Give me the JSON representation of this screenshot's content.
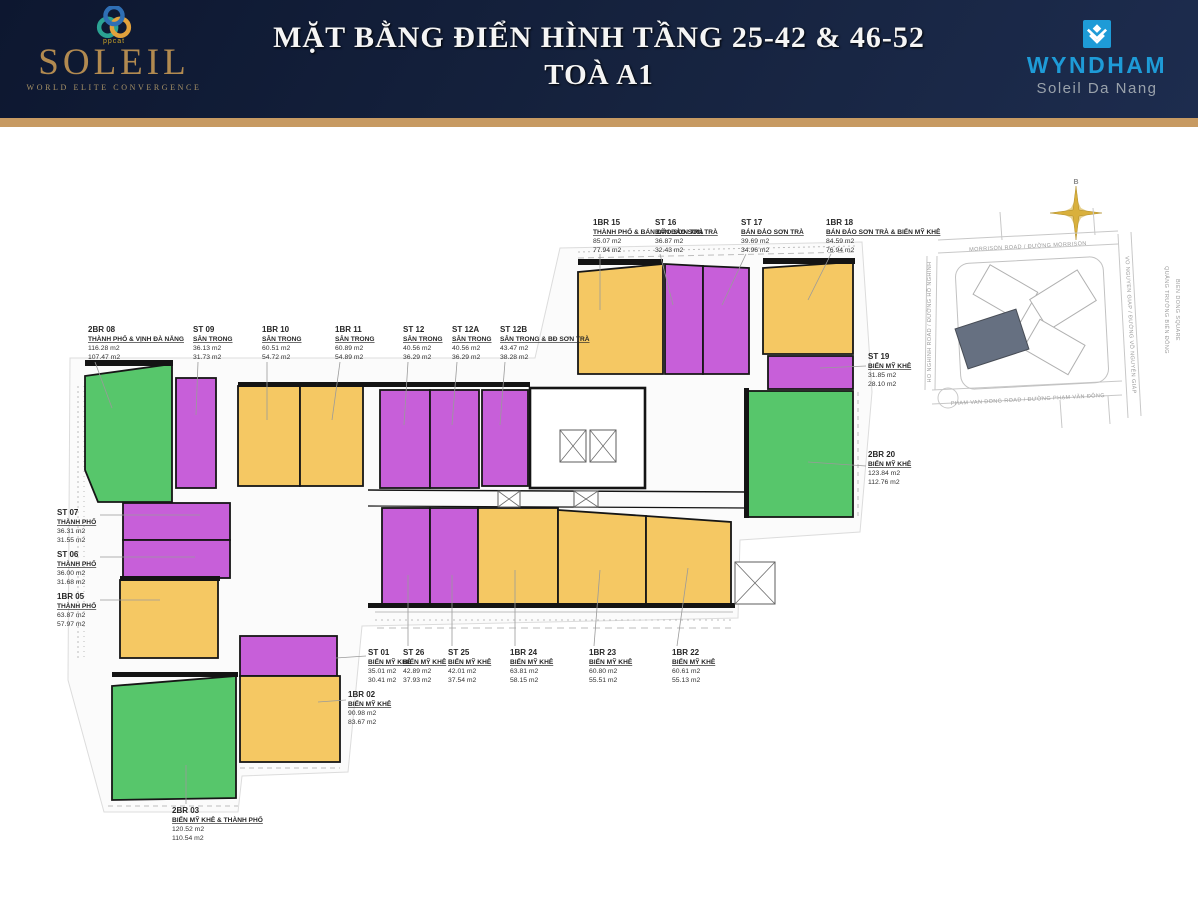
{
  "header": {
    "logo": {
      "name": "SOLEIL",
      "tagline": "WORLD ELITE CONVERGENCE",
      "mark_text": "ppcat"
    },
    "title_line1": "MẶT BẰNG ĐIỂN HÌNH TẦNG 25-42 & 46-52",
    "title_line2": "TOÀ A1",
    "partner": {
      "name": "WYNDHAM",
      "subtitle": "Soleil Da Nang"
    }
  },
  "colors": {
    "studio": "#c75fd9",
    "one_bedroom": "#f5c863",
    "two_bedroom": "#57c66b",
    "header_navy": "#16233f",
    "gold_bar": "#c79a62",
    "wyndham_blue": "#1e9bd7",
    "soleil_gold": "#b28a50"
  },
  "plan": {
    "units": [
      {
        "id": "2br08",
        "code": "2BR 08",
        "view": "THÀNH PHỐ & VỊNH ĐÀ NẴNG",
        "area1": "116.28 m2",
        "area2": "107.47 m2"
      },
      {
        "id": "st09",
        "code": "ST 09",
        "view": "SÂN TRONG",
        "area1": "36.13 m2",
        "area2": "31.73 m2"
      },
      {
        "id": "1br10",
        "code": "1BR 10",
        "view": "SÂN TRONG",
        "area1": "60.51 m2",
        "area2": "54.72 m2"
      },
      {
        "id": "1br11",
        "code": "1BR 11",
        "view": "SÂN TRONG",
        "area1": "60.89 m2",
        "area2": "54.89 m2"
      },
      {
        "id": "st12",
        "code": "ST 12",
        "view": "SÂN TRONG",
        "area1": "40.56 m2",
        "area2": "36.29 m2"
      },
      {
        "id": "st12a",
        "code": "ST 12A",
        "view": "SÂN TRONG",
        "area1": "40.56 m2",
        "area2": "36.29 m2"
      },
      {
        "id": "st12b",
        "code": "ST 12B",
        "view": "SÂN TRONG & BĐ SƠN TRÀ",
        "area1": "43.47 m2",
        "area2": "38.28 m2"
      },
      {
        "id": "1br15",
        "code": "1BR 15",
        "view": "THÀNH PHỐ & BÁN ĐẢO SƠN TRÀ",
        "area1": "85.07 m2",
        "area2": "77.94 m2"
      },
      {
        "id": "st16",
        "code": "ST 16",
        "view": "BÁN ĐẢO SƠN TRÀ",
        "area1": "36.87 m2",
        "area2": "32.43 m2"
      },
      {
        "id": "st17",
        "code": "ST 17",
        "view": "BÁN ĐẢO SƠN TRÀ",
        "area1": "39.69 m2",
        "area2": "34.96 m2"
      },
      {
        "id": "1br18",
        "code": "1BR 18",
        "view": "BÁN ĐẢO SƠN TRÀ & BIỂN MỸ KHÊ",
        "area1": "84.59 m2",
        "area2": "76.94 m2"
      },
      {
        "id": "st19",
        "code": "ST 19",
        "view": "BIỂN MỸ KHÊ",
        "area1": "31.85 m2",
        "area2": "28.10 m2"
      },
      {
        "id": "2br20",
        "code": "2BR 20",
        "view": "BIỂN MỸ KHÊ",
        "area1": "123.84 m2",
        "area2": "112.76 m2"
      },
      {
        "id": "st07",
        "code": "ST 07",
        "view": "THÀNH PHỐ",
        "area1": "36.31 m2",
        "area2": "31.55 m2"
      },
      {
        "id": "st06",
        "code": "ST 06",
        "view": "THÀNH PHỐ",
        "area1": "36.00 m2",
        "area2": "31.68 m2"
      },
      {
        "id": "1br05",
        "code": "1BR 05",
        "view": "THÀNH PHỐ",
        "area1": "63.87 m2",
        "area2": "57.97 m2"
      },
      {
        "id": "st01",
        "code": "ST 01",
        "view": "BIỂN MỸ KHÊ",
        "area1": "35.01 m2",
        "area2": "30.41 m2"
      },
      {
        "id": "st26",
        "code": "ST 26",
        "view": "BIỂN MỸ KHÊ",
        "area1": "42.89 m2",
        "area2": "37.93 m2"
      },
      {
        "id": "st25",
        "code": "ST 25",
        "view": "BIỂN MỸ KHÊ",
        "area1": "42.01 m2",
        "area2": "37.54 m2"
      },
      {
        "id": "1br24",
        "code": "1BR 24",
        "view": "BIỂN MỸ KHÊ",
        "area1": "63.81 m2",
        "area2": "58.15 m2"
      },
      {
        "id": "1br23",
        "code": "1BR 23",
        "view": "BIỂN MỸ KHÊ",
        "area1": "60.80 m2",
        "area2": "55.51 m2"
      },
      {
        "id": "1br22",
        "code": "1BR 22",
        "view": "BIỂN MỸ KHÊ",
        "area1": "60.61 m2",
        "area2": "55.13 m2"
      },
      {
        "id": "1br02",
        "code": "1BR 02",
        "view": "BIỂN MỸ KHÊ",
        "area1": "90.98 m2",
        "area2": "83.67 m2"
      },
      {
        "id": "2br03",
        "code": "2BR 03",
        "view": "BIỂN MỸ KHÊ & THÀNH PHỐ",
        "area1": "120.52 m2",
        "area2": "110.54 m2"
      }
    ]
  },
  "map": {
    "north": "B",
    "road_top": "MORRISON ROAD / ĐƯỜNG MORRISON",
    "road_bottom": "PHAM VAN DONG ROAD / ĐƯỜNG PHẠM VĂN ĐÔNG",
    "road_left": "HO NGHINH ROAD / ĐƯỜNG HỒ NGHINH",
    "road_right": "VO NGUYEN GIAP / ĐƯỜNG VÕ NGUYÊN GIÁP",
    "square_line1": "QUẢNG TRƯỜNG BIỂN ĐÔNG",
    "square_line2": "BIEN DONG SQUARE"
  }
}
